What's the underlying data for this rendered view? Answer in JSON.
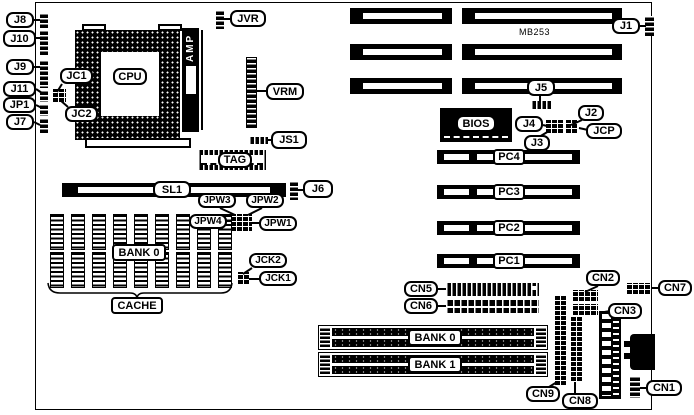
{
  "board": {
    "model": "MB253"
  },
  "colors": {
    "foreground": "#000000",
    "background": "#ffffff"
  },
  "labels": {
    "j8": "J8",
    "j10": "J10",
    "j9": "J9",
    "j11": "J11",
    "jp1": "JP1",
    "j7": "J7",
    "jc1": "JC1",
    "jc2": "JC2",
    "cpu": "CPU",
    "amp": "AMP",
    "jvr": "JVR",
    "vrm": "VRM",
    "js1": "JS1",
    "tag": "TAG",
    "sl1": "SL1",
    "jpw1": "JPW1",
    "jpw2": "JPW2",
    "jpw3": "JPW3",
    "jpw4": "JPW4",
    "cache_bank": "BANK 0",
    "cache": "CACHE",
    "jck1": "JCK1",
    "jck2": "JCK2",
    "j6": "J6",
    "j1": "J1",
    "j5": "J5",
    "j4": "J4",
    "j3": "J3",
    "j2": "J2",
    "jcp": "JCP",
    "bios": "BIOS",
    "pc4": "PC4",
    "pc3": "PC3",
    "pc2": "PC2",
    "pc1": "PC1",
    "cn5": "CN5",
    "cn6": "CN6",
    "cn2": "CN2",
    "cn7": "CN7",
    "cn3": "CN3",
    "simm_bank0": "BANK 0",
    "simm_bank1": "BANK 1",
    "cn9": "CN9",
    "cn8": "CN8",
    "cn1": "CN1"
  }
}
